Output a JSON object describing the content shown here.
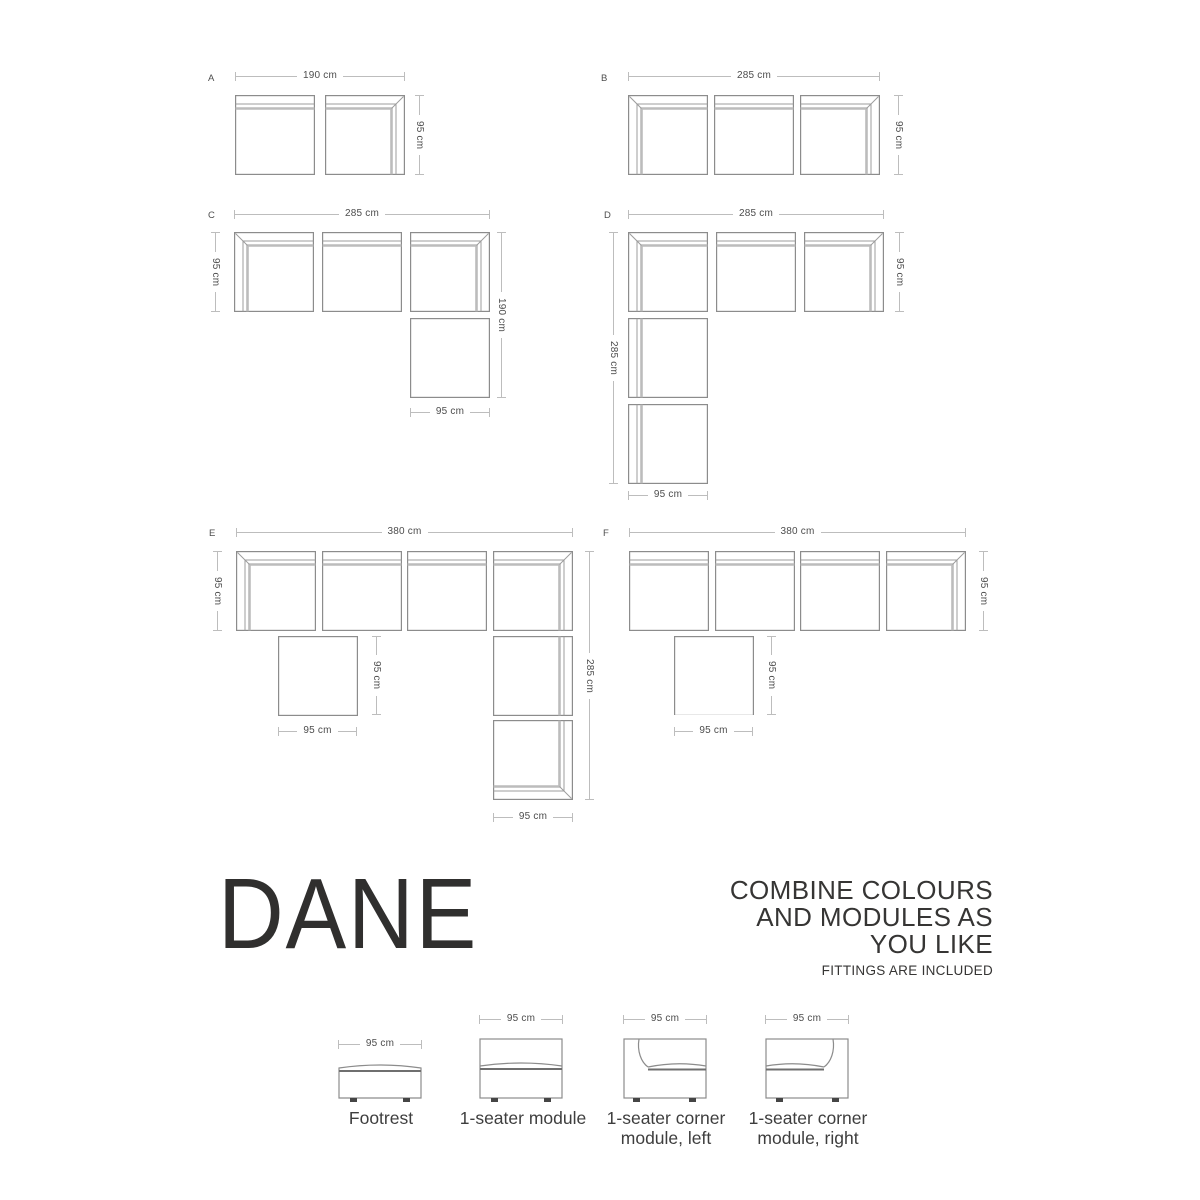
{
  "brand": {
    "name": "DANE"
  },
  "tagline": {
    "line1": "COMBINE COLOURS",
    "line2": "AND MODULES AS",
    "line3": "YOU LIKE",
    "note": "FITTINGS ARE INCLUDED"
  },
  "configs": {
    "a": {
      "letter": "A",
      "top": "190 cm",
      "right": "95 cm"
    },
    "b": {
      "letter": "B",
      "top": "285 cm",
      "right": "95 cm"
    },
    "c": {
      "letter": "C",
      "top": "285 cm",
      "left": "95 cm",
      "right": "190 cm",
      "bottom": "95 cm"
    },
    "d": {
      "letter": "D",
      "top": "285 cm",
      "left": "285 cm",
      "right": "95 cm",
      "bottom": "95 cm"
    },
    "e": {
      "letter": "E",
      "top": "380 cm",
      "left": "95 cm",
      "right": "285 cm",
      "footrest_side": "95 cm",
      "footrest_bottom": "95 cm",
      "bottom": "95 cm"
    },
    "f": {
      "letter": "F",
      "top": "380 cm",
      "right": "95 cm",
      "footrest_side": "95 cm",
      "footrest_bottom": "95 cm"
    }
  },
  "legend": {
    "items": [
      {
        "dim": "95 cm",
        "label": "Footrest"
      },
      {
        "dim": "95 cm",
        "label": "1-seater module"
      },
      {
        "dim": "95 cm",
        "label": "1-seater corner module, left"
      },
      {
        "dim": "95 cm",
        "label": "1-seater corner module, right"
      }
    ]
  },
  "colors": {
    "outline": "#8c8c8c",
    "accent": "#bcbcbc",
    "dim_line": "#bdbdbd",
    "text": "#3e3e3e",
    "brand": "#302f2e",
    "background": "#ffffff"
  }
}
